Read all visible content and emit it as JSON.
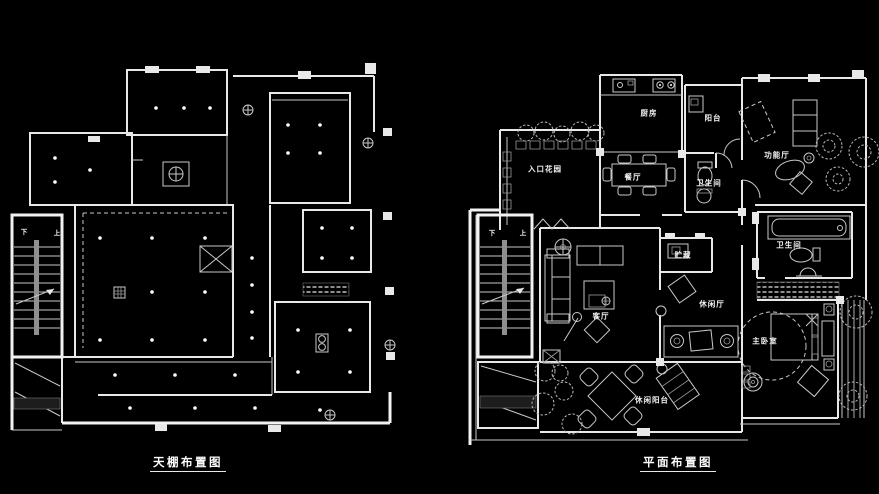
{
  "colors": {
    "background": "#000000",
    "line": "#e8e8e8"
  },
  "ceiling_plan": {
    "caption": "天棚布置图",
    "stairs": {
      "down": "下",
      "up": "上"
    }
  },
  "floor_plan": {
    "caption": "平面布置图",
    "stairs": {
      "down": "下",
      "up": "上"
    },
    "rooms": [
      {
        "id": "kitchen",
        "label": "厨房"
      },
      {
        "id": "balcony",
        "label": "阳台"
      },
      {
        "id": "entrance-garden",
        "label": "入口花园"
      },
      {
        "id": "dining-room",
        "label": "餐厅"
      },
      {
        "id": "bathroom-north",
        "label": "卫生间"
      },
      {
        "id": "function-hall",
        "label": "功能厅"
      },
      {
        "id": "storage",
        "label": "贮藏"
      },
      {
        "id": "bathroom-master",
        "label": "卫生间"
      },
      {
        "id": "living-room",
        "label": "客厅"
      },
      {
        "id": "leisure-hall",
        "label": "休闲厅"
      },
      {
        "id": "master-bedroom",
        "label": "主卧室"
      },
      {
        "id": "leisure-balcony",
        "label": "休闲阳台"
      }
    ]
  }
}
